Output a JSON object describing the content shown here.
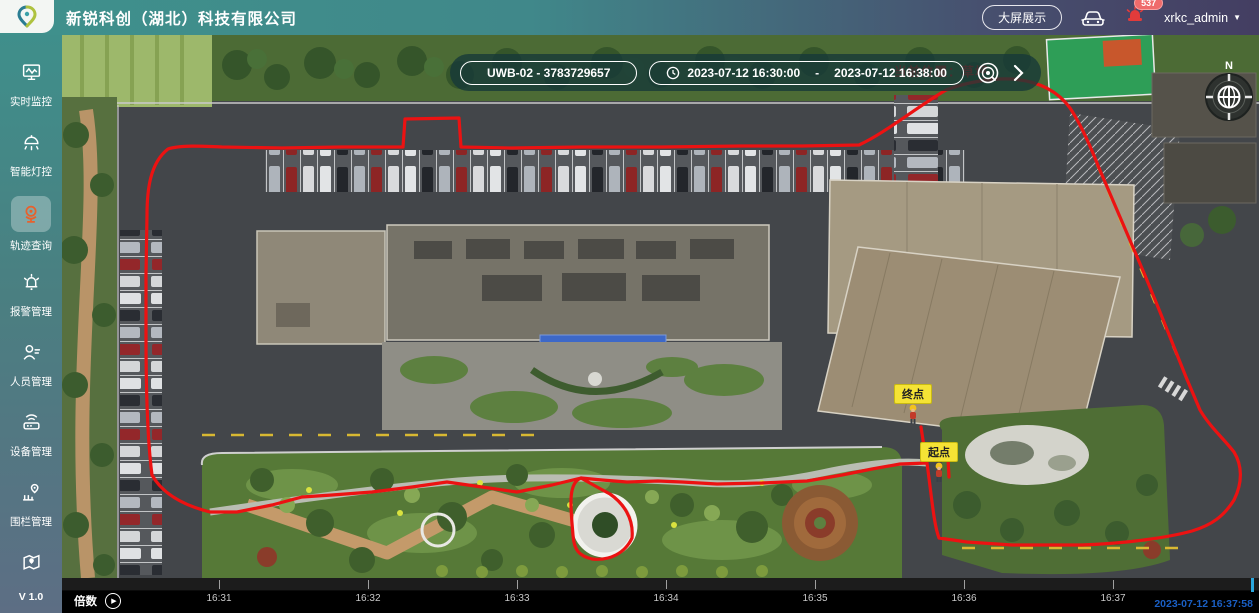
{
  "header": {
    "company": "新锐科创（湖北）科技有限公司",
    "big_screen_btn": "大屏展示",
    "badge_count": "537",
    "user": "xrkc_admin",
    "caret": "▼",
    "icons": [
      "logo-pin-icon",
      "car-icon",
      "siren-icon"
    ]
  },
  "sidebar": {
    "items": [
      {
        "label": "实时监控",
        "icon": "monitor-icon",
        "active": false
      },
      {
        "label": "智能灯控",
        "icon": "lamp-icon",
        "active": false
      },
      {
        "label": "轨迹查询",
        "icon": "track-camera-icon",
        "active": true
      },
      {
        "label": "报警管理",
        "icon": "alarm-bell-icon",
        "active": false
      },
      {
        "label": "人员管理",
        "icon": "person-icon",
        "active": false
      },
      {
        "label": "设备管理",
        "icon": "device-icon",
        "active": false
      },
      {
        "label": "围栏管理",
        "icon": "fence-pin-icon",
        "active": false
      },
      {
        "label": "",
        "icon": "map-icon",
        "active": false
      }
    ],
    "version": "V 1.0",
    "active_icon_color": "#e8612c"
  },
  "toolbar": {
    "device_select": "UWB-02 - 3783729657",
    "date_start": "2023-07-12 16:30:00",
    "date_separator": "-",
    "date_end": "2023-07-12 16:38:00",
    "icons": [
      "clock-icon",
      "search-icon",
      "chevron-right-icon"
    ]
  },
  "map": {
    "current_location_label": "当前位置：草坪",
    "compass_label": "N",
    "end_marker": "终点",
    "start_marker": "起点",
    "trajectory_color": "#ec1212",
    "marker_label_bg": "#f5e335"
  },
  "timeline": {
    "speed_label": "倍数",
    "play_glyph": "▶",
    "ticks": [
      "16:31",
      "16:32",
      "16:33",
      "16:34",
      "16:35",
      "16:36",
      "16:37"
    ],
    "current_time": "2023-07-12 16:37:58",
    "playhead_color": "#2aa7dd",
    "timestamp_color": "#1a5fc4"
  }
}
